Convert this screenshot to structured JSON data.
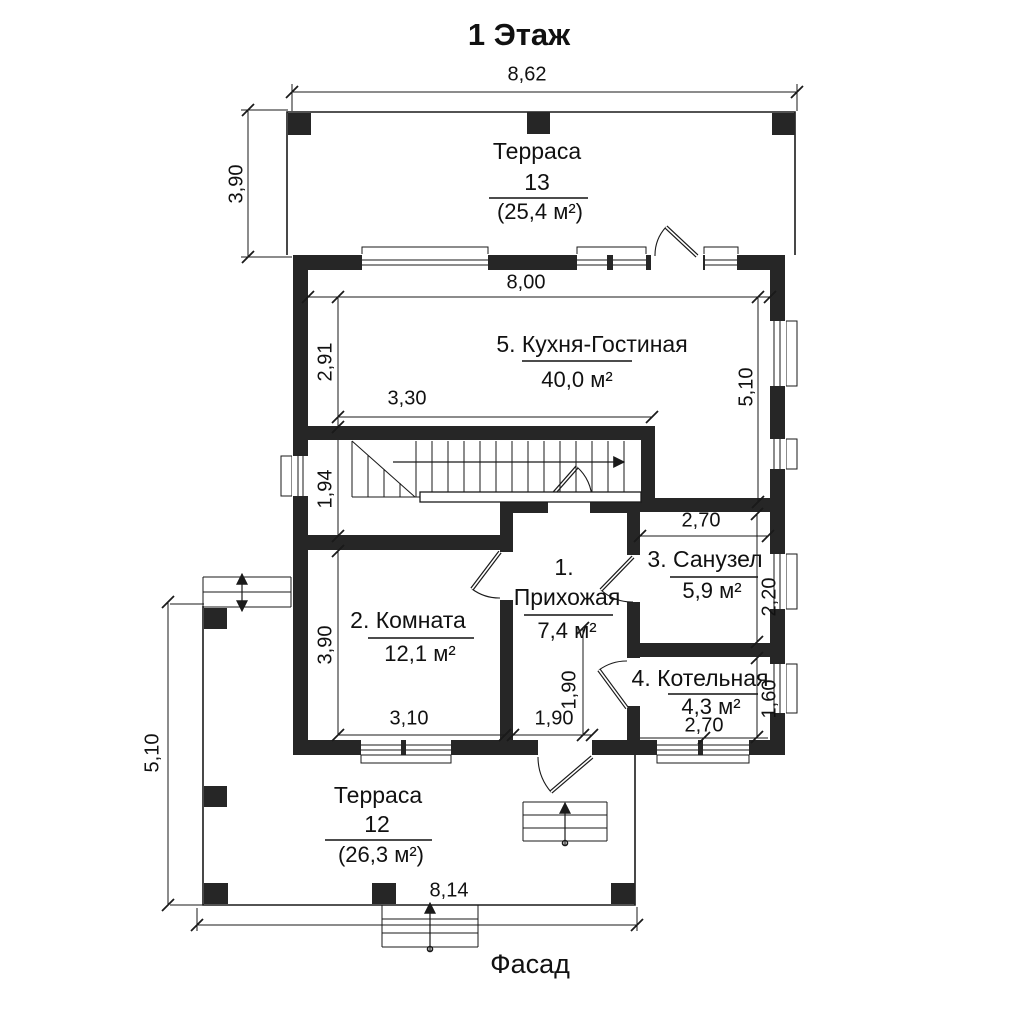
{
  "title": "1 Этаж",
  "facade": "Фасад",
  "rooms": {
    "terrace13": {
      "name": "Терраса",
      "number": "13",
      "area": "(25,4 м²)"
    },
    "kitchen": {
      "name": "5. Кухня-Гостиная",
      "area": "40,0 м²"
    },
    "room": {
      "name": "2. Комната",
      "area": "12,1 м²"
    },
    "hallway": {
      "number": "1.",
      "name": "Прихожая",
      "area": "7,4 м²"
    },
    "bathroom": {
      "name": "3. Санузел",
      "area": "5,9 м²"
    },
    "boiler": {
      "name": "4. Котельная",
      "area": "4,3 м²"
    },
    "terrace12": {
      "name": "Терраса",
      "number": "12",
      "area": "(26,3 м²)"
    }
  },
  "dims": {
    "total_width": "8,62",
    "terrace13_depth": "3,90",
    "kitchen_width": "8,00",
    "kitchen_left_height": "2,91",
    "stairs_width": "3,30",
    "kitchen_right_height": "5,10",
    "stair_hall_height": "1,94",
    "room_height": "3,90",
    "room_width": "3,10",
    "hallway_width": "1,90",
    "hallway_door_height": "1,90",
    "bathroom_width": "2,70",
    "bathroom_height": "2,20",
    "boiler_width": "2,70",
    "boiler_height": "1,60",
    "terrace12_side_height": "5,10",
    "facade_width": "8,14"
  },
  "colors": {
    "wall": "#262626",
    "line": "#1a1a1a",
    "background": "#ffffff"
  }
}
